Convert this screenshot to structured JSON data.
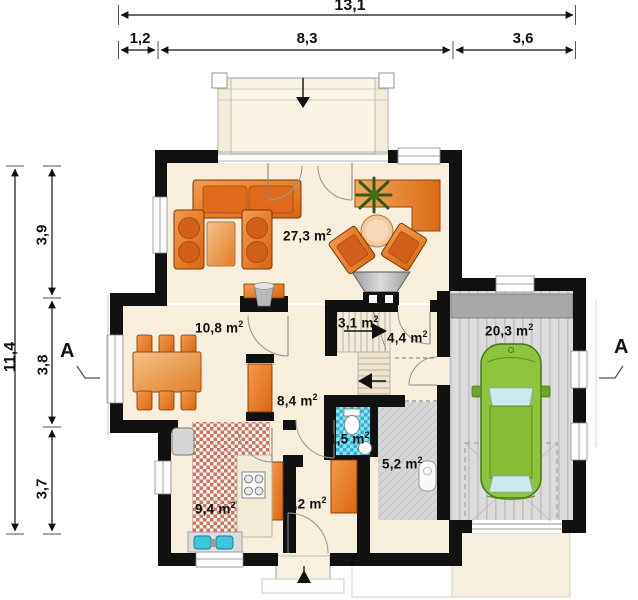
{
  "units": {
    "base": "m",
    "sup": "2"
  },
  "dims": {
    "top_total": "13,1",
    "top_segments": [
      "1,2",
      "8,3",
      "3,6"
    ],
    "left_total": "11,4",
    "left_segments": [
      "3,9",
      "3,8",
      "3,7"
    ]
  },
  "section": {
    "left": "A",
    "right": "A"
  },
  "rooms": {
    "living": {
      "area": "27,3"
    },
    "dining": {
      "area": "10,8"
    },
    "stairs": {
      "area": "3,1"
    },
    "hall_upper": {
      "area": "4,4"
    },
    "hall_lower": {
      "area": "8,4"
    },
    "wc": {
      "area": "1,5"
    },
    "utility": {
      "area": "5,2"
    },
    "kitchen": {
      "area": "9,4"
    },
    "vestibule": {
      "area": "3,2"
    },
    "garage": {
      "area": "20,3"
    }
  },
  "palette": {
    "wall": "#111111",
    "floor_cream": "#f7efdc",
    "furniture_orange": "#e8791f",
    "car_green": "#8fc53c",
    "wc_tile_cyan": "#2cb4d4",
    "kitchen_tile_red": "#cb7360",
    "garage_floor_gray": "#dcdcdc"
  }
}
